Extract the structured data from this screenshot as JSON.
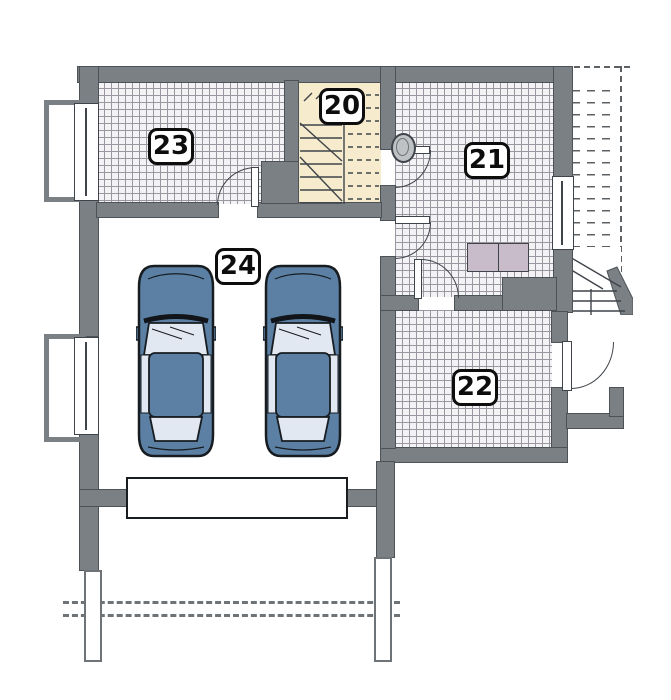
{
  "rooms": [
    {
      "number": "20"
    },
    {
      "number": "21"
    },
    {
      "number": "22"
    },
    {
      "number": "23"
    },
    {
      "number": "24"
    }
  ],
  "colors": {
    "wall": "#7b8085",
    "tile_floor": "#f3f2f4",
    "tile_grid": "#9a97a1",
    "stairwell_floor": "#f6eccd",
    "car_body": "#5b80a4",
    "car_glass": "#e2e8f1",
    "appliance": "#c9bcca",
    "line_outline": "#3f444a"
  }
}
